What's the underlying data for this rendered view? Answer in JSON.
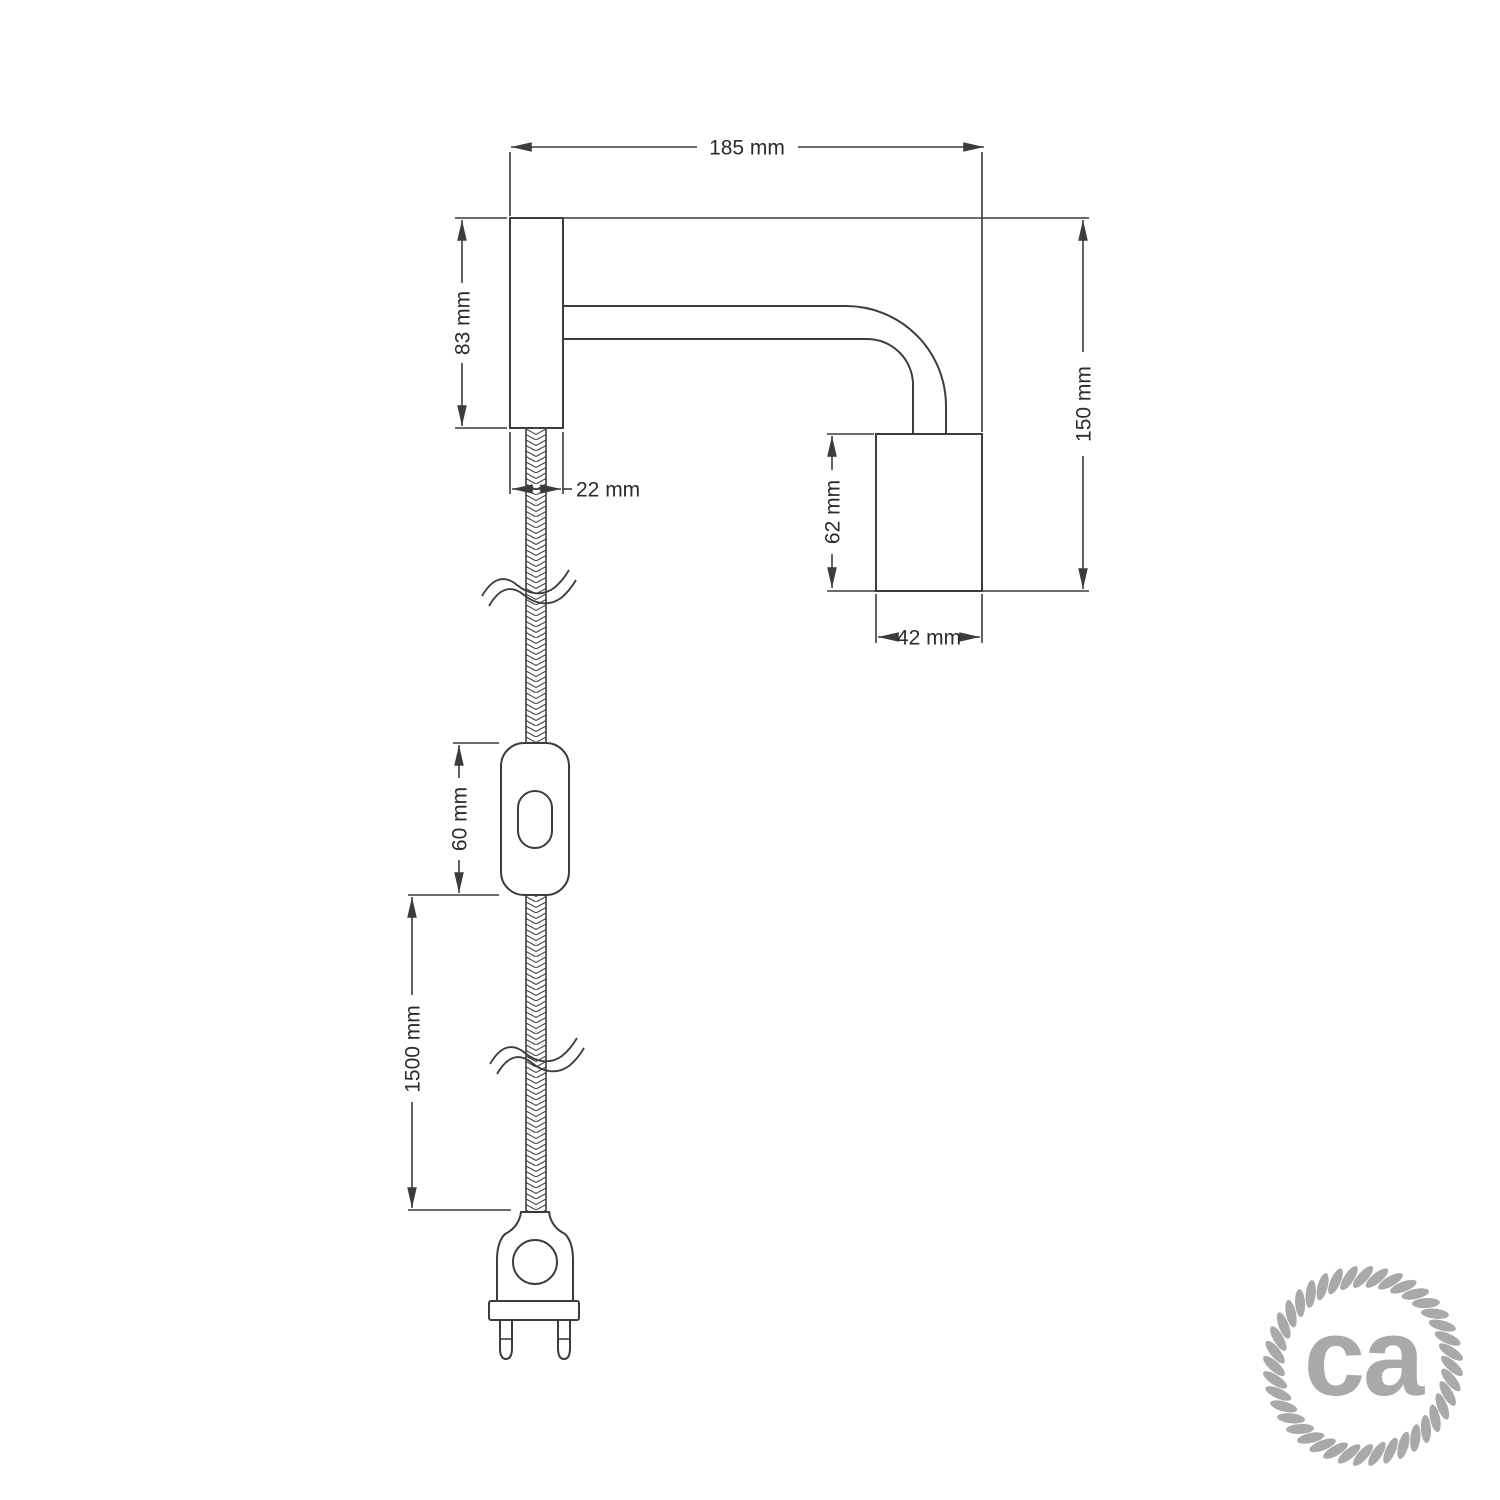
{
  "dimensions": {
    "total_width": "185 mm",
    "wall_mount_height": "83 mm",
    "wall_mount_width": "22 mm",
    "total_height": "150 mm",
    "socket_height": "62 mm",
    "socket_width": "42 mm",
    "switch_length": "60 mm",
    "cable_length": "1500 mm"
  },
  "logo": {
    "text": "ca",
    "color": "#a9a9a9"
  },
  "colors": {
    "line": "#3c3c3c",
    "text": "#2b2b2b",
    "background": "#ffffff"
  }
}
